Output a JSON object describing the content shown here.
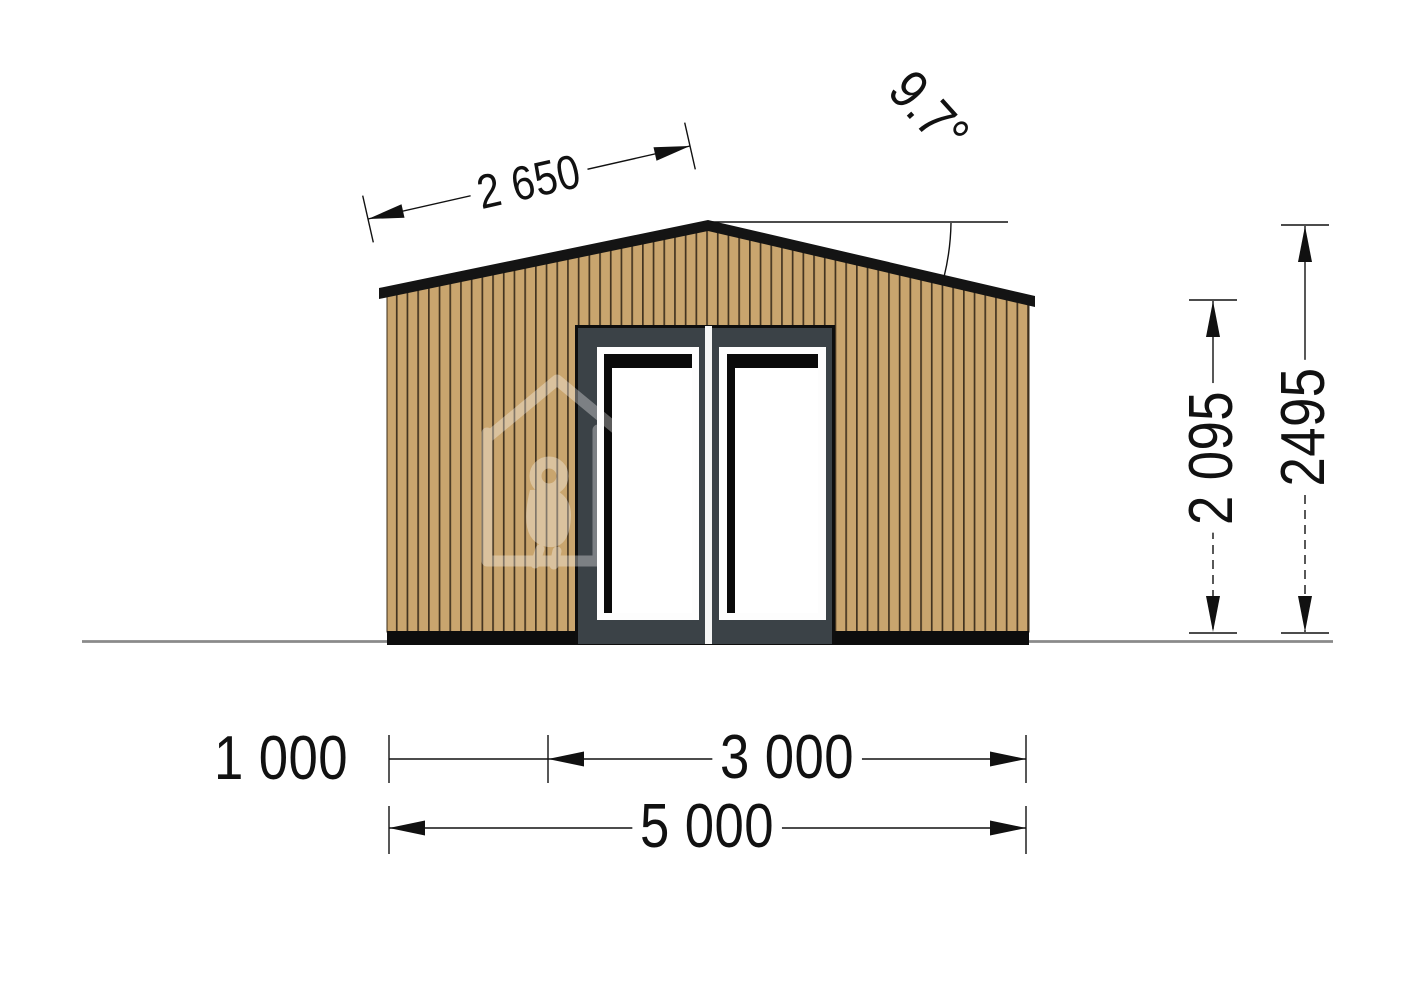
{
  "drawing": {
    "title": "Garden cabin front elevation",
    "labels": {
      "roof_slope_length": "2 650",
      "roof_pitch_angle": "9.7°",
      "wall_height": "2 095",
      "ridge_height": "2495",
      "left_segment_width": "1 000",
      "middle_segment_width": "3 000",
      "total_width": "5 000"
    },
    "colors": {
      "wood_cladding": "#c9a56e",
      "plank_joint": "#2b2013",
      "door_frame": "#3b4247",
      "trim_black": "#0d0d0d",
      "ground_line": "#8a8a8a",
      "dimension_ink": "#111111"
    }
  }
}
